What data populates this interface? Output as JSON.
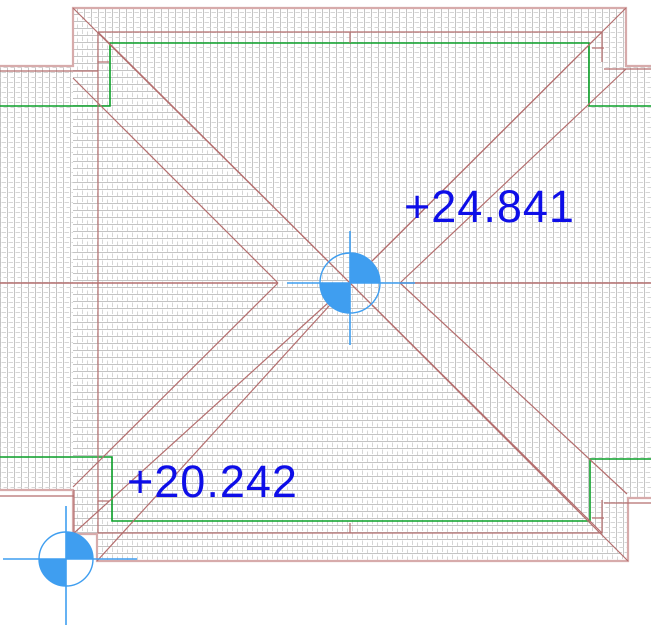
{
  "view": {
    "type": "cad-roof-plan",
    "description": "Roof plan view with hatched hip roof, spot elevation markers and elevation annotations"
  },
  "annotations": {
    "upper_roof_elevation": "+24.841",
    "lower_roof_elevation": "+20.242"
  },
  "markers": {
    "ridge_marker": {
      "name": "spot-elevation-marker",
      "x": 350,
      "y": 283
    },
    "corner_marker": {
      "name": "spot-elevation-marker",
      "x": 66,
      "y": 559
    }
  },
  "colors": {
    "label_blue": "#0e0ee8",
    "marker_blue": "#3f9ef0",
    "roof_line": "#b46e6e",
    "roof_edge_pale": "#d7abab",
    "wall_line_green": "#0aa028",
    "hatch_dark": "#c4c4c4",
    "hatch_light": "#d6d6d6",
    "background": "#ffffff"
  }
}
